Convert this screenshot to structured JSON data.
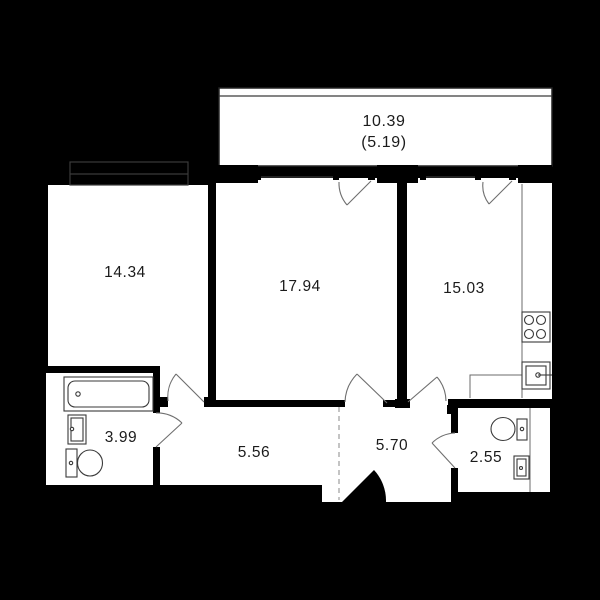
{
  "plan": {
    "background_color": "#000000",
    "floor_color": "#ffffff",
    "line_color": "#3a3a3a",
    "text_color": "#1b1b1b",
    "rooms": [
      {
        "id": "balcony",
        "label": "10.39",
        "sublabel": "(5.19)"
      },
      {
        "id": "living-room",
        "label": "14.34"
      },
      {
        "id": "bedroom",
        "label": "17.94"
      },
      {
        "id": "kitchen",
        "label": "15.03"
      },
      {
        "id": "bathroom",
        "label": "3.99"
      },
      {
        "id": "hallway",
        "label": "5.56"
      },
      {
        "id": "entry-hall",
        "label": "5.70"
      },
      {
        "id": "wc",
        "label": "2.55"
      }
    ]
  }
}
